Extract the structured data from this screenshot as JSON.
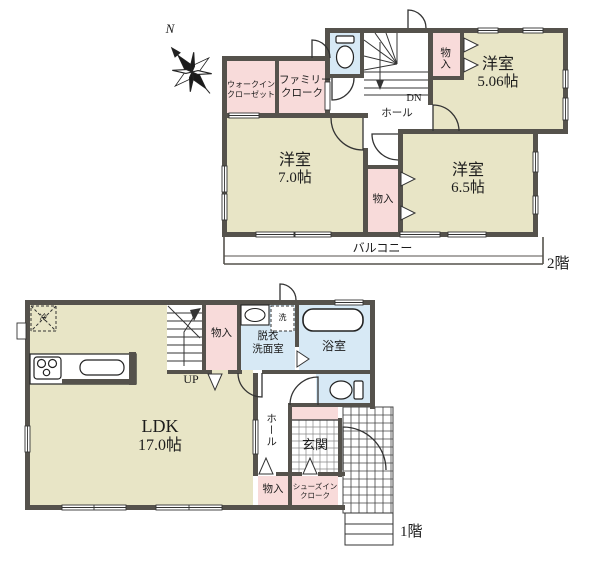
{
  "compass": {
    "north_label": "N"
  },
  "floor2": {
    "floor_label": "2階",
    "walk_in_closet": {
      "line1": "ウォークイン",
      "line2": "クローゼット"
    },
    "family_cloak": {
      "line1": "ファミリー",
      "line2": "クローク"
    },
    "storage_top": "物入",
    "hall": "ホール",
    "stairs_down": "DN",
    "room_506": {
      "name": "洋室",
      "size": "5.06帖"
    },
    "room_70": {
      "name": "洋室",
      "size": "7.0帖"
    },
    "storage_mid": "物入",
    "room_65": {
      "name": "洋室",
      "size": "6.5帖"
    },
    "balcony": "バルコニー"
  },
  "floor1": {
    "floor_label": "1階",
    "ldk": {
      "name": "LDK",
      "size": "17.0帖"
    },
    "stairs_up": "UP",
    "storage_stairs": "物入",
    "washroom": {
      "line1": "脱衣",
      "line2": "洗面室"
    },
    "bath": "浴室",
    "fridge": "冷",
    "washer": "洗",
    "hall": "ホール",
    "entrance": "玄関",
    "storage_hall": "物入",
    "shoes_closet": {
      "line1": "シューズイン",
      "line2": "クローク"
    }
  },
  "colors": {
    "wall": "#55524c",
    "room_cream": "#e8e5c6",
    "closet_pink": "#f8dbda",
    "wet_blue": "#d7e9f5",
    "line": "#333333"
  }
}
